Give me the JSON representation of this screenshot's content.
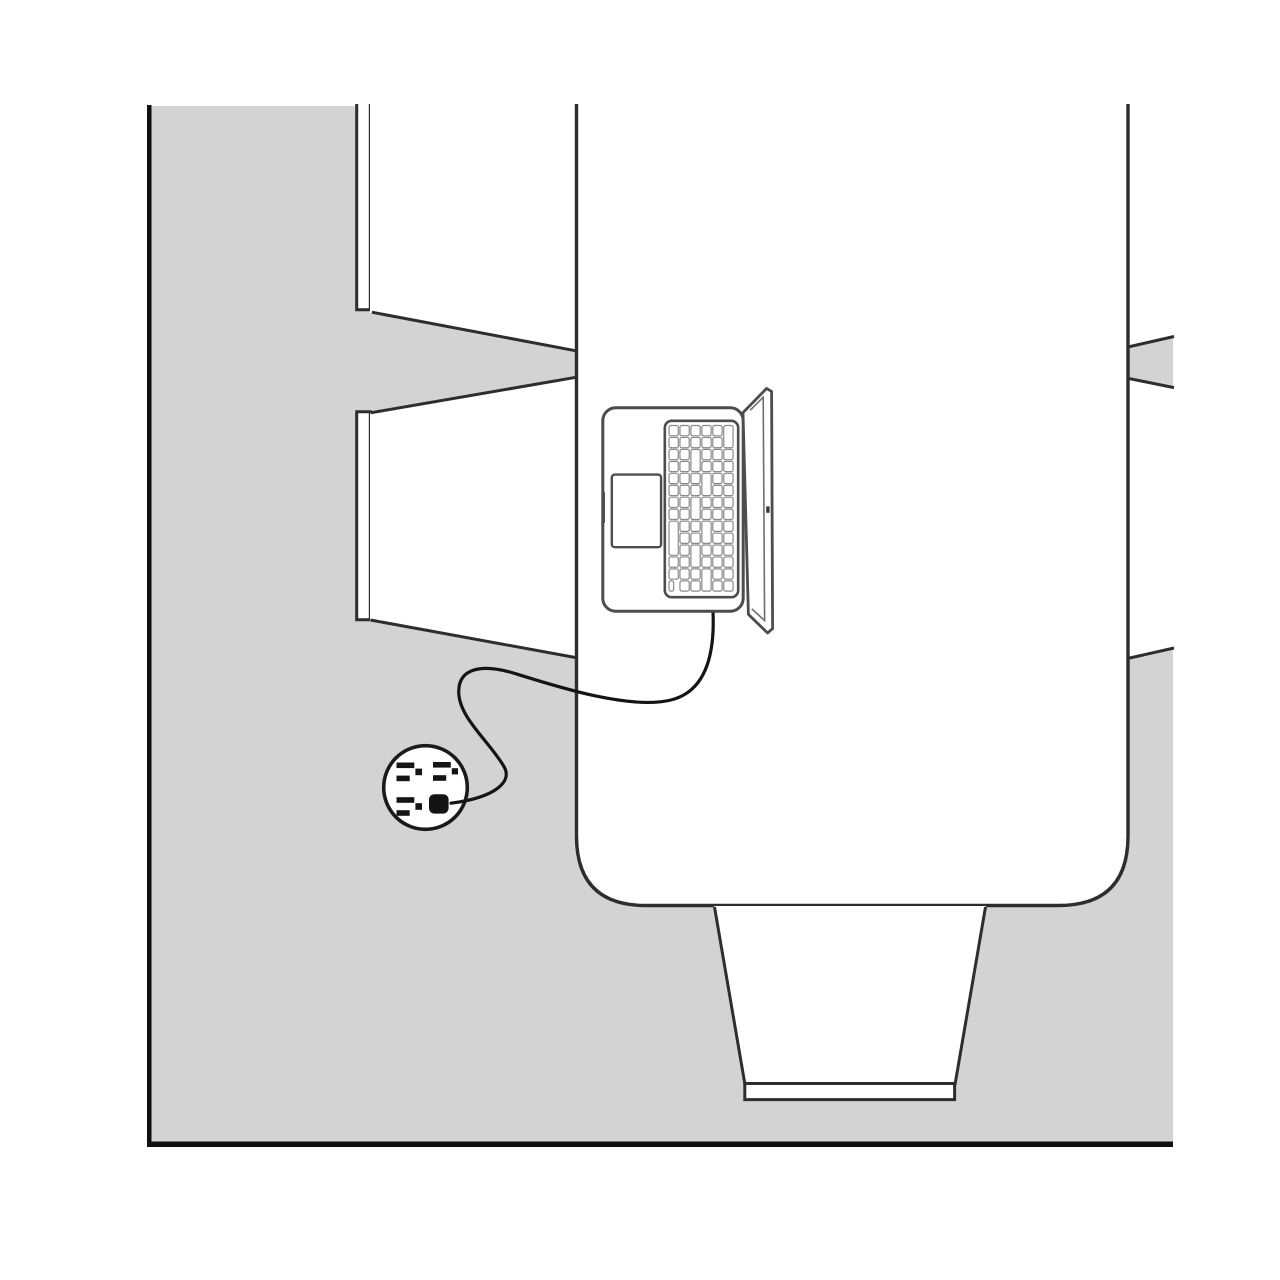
{
  "scene": {
    "description": "Overhead (top-down) monochrome line illustration of a workspace: a laptop sits on a large table, its power cord curving down to a round floor outlet; chairs are tucked around the table; the floor is light gray with black border lines on the left and bottom edges.",
    "view": "top-down",
    "text_content": "none"
  },
  "colors": {
    "page_bg": "#ffffff",
    "floor": "#d3d3d3",
    "furniture_fill": "#ffffff",
    "outline_dark": "#2d2d2d",
    "border_black": "#0f0f0f",
    "laptop_stroke": "#4d4d4d",
    "bezel_stroke": "#6e6e6e",
    "key_stroke": "#8a8a8a",
    "key_fill": "#ffffff",
    "cord": "#141414",
    "plug_fill": "#141414",
    "slot_fill": "#141414",
    "outlet_stroke": "#1a1a1a",
    "notch_fill": "#3a3a3a"
  },
  "objects": {
    "table": {
      "label": "table",
      "shape": "rounded rectangle, cropped at top"
    },
    "laptop": {
      "label": "open laptop",
      "parts": [
        "body",
        "trackpad",
        "keyboard",
        "open lid",
        "side port"
      ]
    },
    "outlet": {
      "label": "round floor outlet",
      "receptacles_total": 4,
      "receptacles_free": 3,
      "receptacles_occupied": 1
    },
    "plug": {
      "label": "power plug inserted in outlet"
    },
    "cord": {
      "label": "power cord from laptop to outlet"
    },
    "chairs": {
      "visible_count": 5,
      "positions": [
        "top-left",
        "bottom-left",
        "top-right (cropped)",
        "mid-right (cropped)",
        "bottom-center"
      ]
    }
  }
}
